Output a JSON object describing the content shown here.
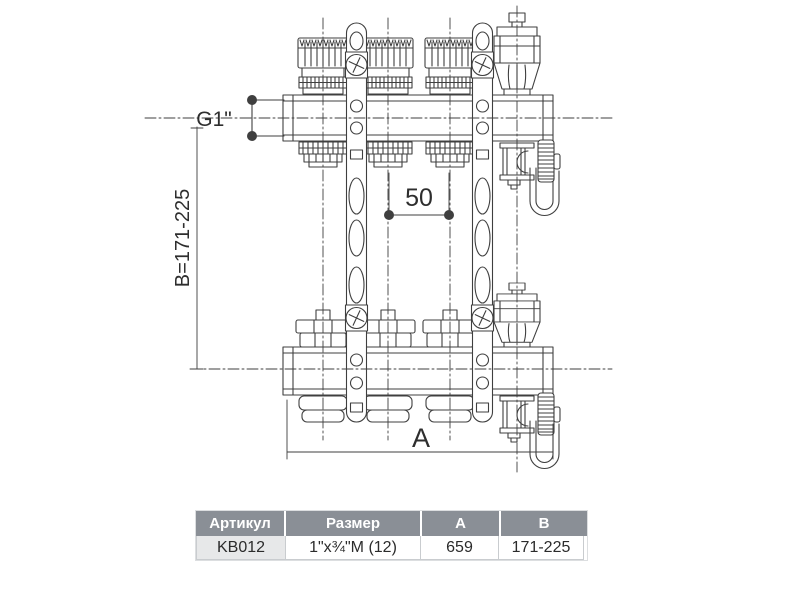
{
  "drawing": {
    "thread_label": "G1\"",
    "spacing_label": "50",
    "height_label": "B=171-225",
    "length_label": "A"
  },
  "table": {
    "headers": [
      "Артикул",
      "Размер",
      "A",
      "B"
    ],
    "row": [
      "KB012",
      "1\"x¾\"M (12)",
      "659",
      "171-225"
    ]
  },
  "colors": {
    "line": "#3f3f3f",
    "header_bg": "#8a8f96",
    "header_text": "#ffffff",
    "first_cell_bg": "#e7e8e9"
  }
}
